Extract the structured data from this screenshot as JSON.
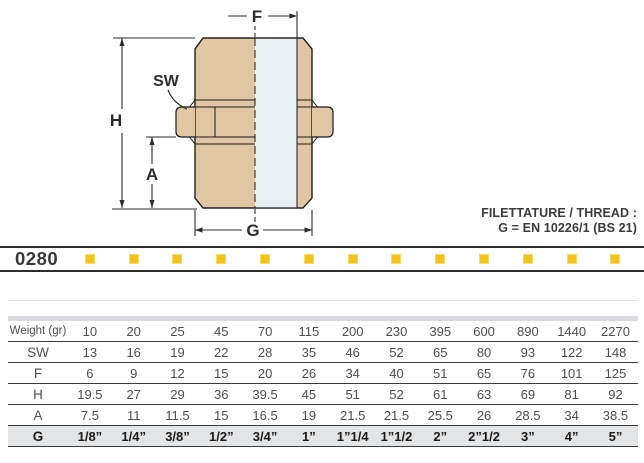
{
  "diagram": {
    "labels": {
      "f": "F",
      "h": "H",
      "a": "A",
      "g": "G",
      "sw": "SW"
    }
  },
  "thread_note": {
    "line1": "FILETTATURE / THREAD :",
    "line2": "G = EN 10226/1 (BS 21)"
  },
  "product_band": {
    "code": "0280",
    "square_count": 13,
    "square_color": "#F3C41C"
  },
  "table": {
    "rows": [
      {
        "label": "Weight (gr)",
        "values": [
          "10",
          "20",
          "25",
          "45",
          "70",
          "115",
          "200",
          "230",
          "395",
          "600",
          "890",
          "1440",
          "2270"
        ]
      },
      {
        "label": "SW",
        "values": [
          "13",
          "16",
          "19",
          "22",
          "28",
          "35",
          "46",
          "52",
          "65",
          "80",
          "93",
          "122",
          "148"
        ]
      },
      {
        "label": "F",
        "values": [
          "6",
          "9",
          "12",
          "15",
          "20",
          "26",
          "34",
          "40",
          "51",
          "65",
          "76",
          "101",
          "125"
        ]
      },
      {
        "label": "H",
        "values": [
          "19.5",
          "27",
          "29",
          "36",
          "39.5",
          "45",
          "51",
          "52",
          "61",
          "63",
          "69",
          "81",
          "92"
        ]
      },
      {
        "label": "A",
        "values": [
          "7.5",
          "11",
          "11.5",
          "15",
          "16.5",
          "19",
          "21.5",
          "21.5",
          "25.5",
          "26",
          "28.5",
          "34",
          "38.5"
        ]
      },
      {
        "label": "G",
        "values": [
          "1/8”",
          "1/4”",
          "3/8”",
          "1/2”",
          "3/4”",
          "1”",
          "1”1/4",
          "1”1/2",
          "2”",
          "2”1/2",
          "3”",
          "4”",
          "5”"
        ]
      }
    ]
  },
  "colors": {
    "body_tan": "#E0C6A3",
    "bore_blue": "#E6EFF1",
    "square_yellow": "#F3C41C",
    "line_dark": "#2c2d2f",
    "table_text": "#4d4e50",
    "highlight_row_bg": "#e3e4e6"
  }
}
